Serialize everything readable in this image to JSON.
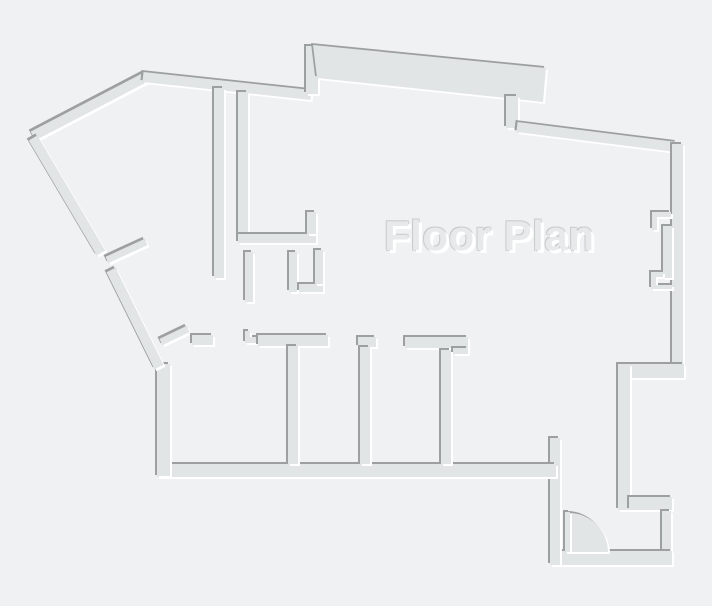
{
  "title": {
    "text": "Floor Plan"
  },
  "canvas": {
    "width": 712,
    "height": 606
  },
  "colors": {
    "background": "#f0f1f2",
    "wall_fill": "#e2e5e6",
    "edge_shadow": "#9da0a1",
    "edge_highlight": "#ffffff",
    "title_fill": "#e7e9ea",
    "title_edge": "#c8cbcc"
  },
  "floor_plan": {
    "segments": [
      {
        "name": "exterior-wall-nw-diagonal",
        "kind": "line",
        "x1": 33,
        "y1": 136,
        "x2": 146,
        "y2": 77,
        "sw": 10
      },
      {
        "name": "exterior-wall-top-left",
        "kind": "line",
        "x1": 143,
        "y1": 77,
        "x2": 311,
        "y2": 95,
        "sw": 10
      },
      {
        "name": "exterior-wall-top-step",
        "kind": "rect",
        "x": 306,
        "y": 46,
        "w": 12,
        "h": 48
      },
      {
        "name": "exterior-wall-top-terrace",
        "kind": "path",
        "d": "M313,45 L546,68 L543,102 L317,78 Z"
      },
      {
        "name": "exterior-wall-top-jog",
        "kind": "rect",
        "x": 506,
        "y": 96,
        "w": 12,
        "h": 32
      },
      {
        "name": "exterior-wall-ne-diagonal",
        "kind": "line",
        "x1": 517,
        "y1": 127,
        "x2": 676,
        "y2": 147,
        "sw": 10
      },
      {
        "name": "exterior-wall-right",
        "kind": "rect",
        "x": 672,
        "y": 144,
        "w": 11,
        "h": 222
      },
      {
        "name": "window-jamb-upper",
        "kind": "path",
        "d": "M652,212 h19 v5 h-14 v13 h-5 Z"
      },
      {
        "name": "window-pane",
        "kind": "rect",
        "x": 663,
        "y": 226,
        "w": 9,
        "h": 52
      },
      {
        "name": "window-jamb-lower",
        "kind": "path",
        "d": "M651,272 h12 v5 h-7 v8 h16 v4 h-21 Z"
      },
      {
        "name": "exterior-wall-right-step",
        "kind": "rect",
        "x": 618,
        "y": 364,
        "w": 66,
        "h": 14
      },
      {
        "name": "exterior-wall-right-inset",
        "kind": "rect",
        "x": 618,
        "y": 364,
        "w": 12,
        "h": 146
      },
      {
        "name": "entry-wall-top",
        "kind": "rect",
        "x": 629,
        "y": 497,
        "w": 43,
        "h": 13
      },
      {
        "name": "entry-wall-right",
        "kind": "rect",
        "x": 662,
        "y": 511,
        "w": 9,
        "h": 41
      },
      {
        "name": "entry-wall-bottom",
        "kind": "rect",
        "x": 550,
        "y": 551,
        "w": 122,
        "h": 14
      },
      {
        "name": "entry-wall-left",
        "kind": "rect",
        "x": 550,
        "y": 438,
        "w": 10,
        "h": 127
      },
      {
        "name": "exterior-wall-bottom",
        "kind": "rect",
        "x": 157,
        "y": 464,
        "w": 399,
        "h": 13
      },
      {
        "name": "exterior-wall-left",
        "kind": "rect",
        "x": 157,
        "y": 364,
        "w": 13,
        "h": 112
      },
      {
        "name": "exterior-wall-sw-diagonal-a",
        "kind": "line",
        "x1": 33,
        "y1": 138,
        "x2": 101,
        "y2": 253,
        "sw": 10
      },
      {
        "name": "exterior-wall-sw-diagonal-b",
        "kind": "line",
        "x1": 111,
        "y1": 270,
        "x2": 159,
        "y2": 367,
        "sw": 10
      },
      {
        "name": "door-leaf-west",
        "kind": "line",
        "x1": 107,
        "y1": 260,
        "x2": 146,
        "y2": 242,
        "sw": 7
      },
      {
        "name": "door-leaf-rooms",
        "kind": "line",
        "x1": 161,
        "y1": 342,
        "x2": 188,
        "y2": 329,
        "sw": 7
      },
      {
        "name": "interior-wall-vertical-1",
        "kind": "rect",
        "x": 214,
        "y": 88,
        "w": 10,
        "h": 190
      },
      {
        "name": "interior-wall-vertical-2",
        "kind": "rect",
        "x": 238,
        "y": 92,
        "w": 10,
        "h": 150
      },
      {
        "name": "interior-wall-horizontal-1",
        "kind": "rect",
        "x": 238,
        "y": 234,
        "w": 78,
        "h": 9
      },
      {
        "name": "interior-wall-stub-a",
        "kind": "rect",
        "x": 307,
        "y": 212,
        "w": 9,
        "h": 22
      },
      {
        "name": "interior-wall-stub-b",
        "kind": "rect",
        "x": 245,
        "y": 252,
        "w": 8,
        "h": 50
      },
      {
        "name": "interior-wall-stub-c",
        "kind": "rect",
        "x": 289,
        "y": 252,
        "w": 8,
        "h": 40
      },
      {
        "name": "interior-wall-stub-d",
        "kind": "rect",
        "x": 299,
        "y": 284,
        "w": 24,
        "h": 8
      },
      {
        "name": "interior-wall-stub-e",
        "kind": "rect",
        "x": 315,
        "y": 250,
        "w": 8,
        "h": 34
      },
      {
        "name": "room-wall-top-a",
        "kind": "rect",
        "x": 192,
        "y": 335,
        "w": 21,
        "h": 10
      },
      {
        "name": "door-jamb-a",
        "kind": "path",
        "d": "M245,331 h5 v6 h8 v6 h-13 Z"
      },
      {
        "name": "room-wall-top-b",
        "kind": "rect",
        "x": 258,
        "y": 335,
        "w": 70,
        "h": 11
      },
      {
        "name": "room-wall-top-c",
        "kind": "rect",
        "x": 358,
        "y": 337,
        "w": 18,
        "h": 10
      },
      {
        "name": "room-wall-top-d",
        "kind": "rect",
        "x": 405,
        "y": 337,
        "w": 63,
        "h": 11
      },
      {
        "name": "door-jamb-b",
        "kind": "rect",
        "x": 453,
        "y": 348,
        "w": 15,
        "h": 6
      },
      {
        "name": "room-divider-1",
        "kind": "rect",
        "x": 288,
        "y": 346,
        "w": 10,
        "h": 118
      },
      {
        "name": "room-divider-2",
        "kind": "rect",
        "x": 360,
        "y": 347,
        "w": 10,
        "h": 117
      },
      {
        "name": "room-divider-3",
        "kind": "rect",
        "x": 441,
        "y": 350,
        "w": 10,
        "h": 114
      },
      {
        "name": "door-swing-arc",
        "kind": "path",
        "d": "M569,552 L569,513 A39,39 0 0 1 608,552 Z"
      },
      {
        "name": "door-leaf-entry",
        "kind": "rect",
        "x": 565,
        "y": 512,
        "w": 5,
        "h": 40
      }
    ]
  }
}
